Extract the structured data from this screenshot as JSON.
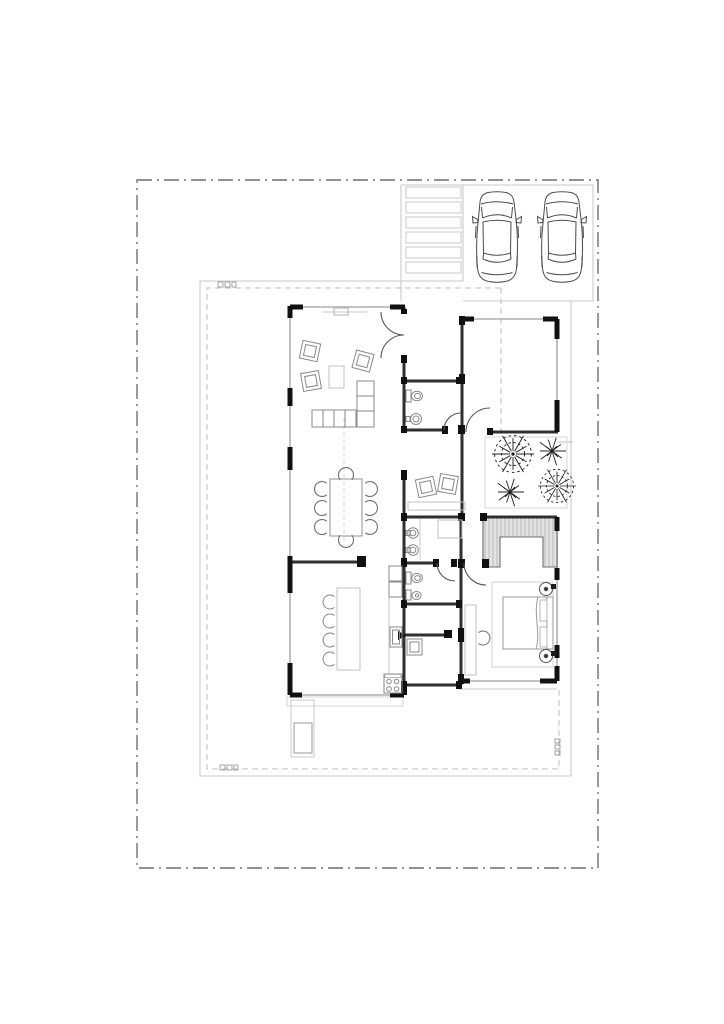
{
  "page": {
    "background": "#ffffff"
  },
  "drawing": {
    "type": "architectural-floor-plan",
    "aria_label": "Single-storey house floor plan on a fenced plot with two parked cars, walkway steps, courtyard trees, living room, dining room, kitchen, bathrooms and master bedroom",
    "palette": {
      "wall_dark": "#2f2f2f",
      "pier_black": "#111111",
      "window_light": "#b9b9b9",
      "plot_line": "#c9c9c9",
      "inner_dashed": "#bdbdbd",
      "site_boundary": "#6f6f6f",
      "furniture": "#8a8a8a",
      "furniture_light": "#c2c2c2",
      "wardrobe_fill": "#e3e3e3",
      "vehicle_line": "#4a4a4a",
      "tree_line": "#222222"
    },
    "inventory": {
      "cars": 2,
      "walkway_steps": 6,
      "trees": 4,
      "dining_chairs": 8,
      "bar_stools": 4,
      "living_armchairs": 3,
      "study_armchairs": 2,
      "wash_basins": 3,
      "toilets": 2,
      "bidets": 1,
      "beds": 1,
      "nightstands": 2,
      "door_swings": 6
    }
  }
}
